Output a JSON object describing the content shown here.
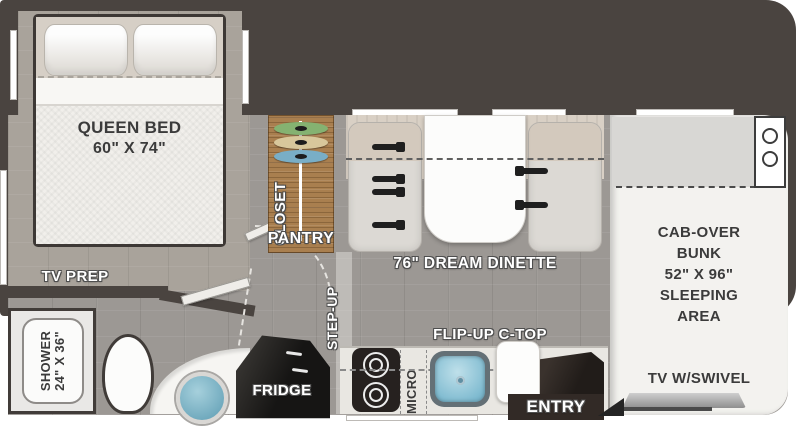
{
  "colors": {
    "wall": "#4a4440",
    "floor": "#9c9894",
    "bedroom_floor": "#a9a39b",
    "closet_wood": "#a97f4f",
    "sink_blue": "#7cb9cf",
    "fridge_black": "#1b1a19",
    "entry_dark": "#322a26"
  },
  "bedroom": {
    "bed_title": "QUEEN BED",
    "bed_size": "60\" X 74\"",
    "tv_prep_label": "TV PREP"
  },
  "bathroom": {
    "shower_title": "SHOWER",
    "shower_size": "24\" X 36\""
  },
  "storage": {
    "closet_label": "CLOSET",
    "pantry_label": "PANTRY"
  },
  "galley": {
    "step_up_label": "STEP-UP",
    "flip_up_label": "FLIP-UP C-TOP",
    "micro_label": "MICRO",
    "fridge_label": "FRIDGE",
    "entry_label": "ENTRY"
  },
  "dinette": {
    "label": "76\" DREAM DINETTE"
  },
  "bunk": {
    "line1": "CAB-OVER",
    "line2": "BUNK",
    "line3": "52\" X 96\"",
    "line4": "SLEEPING",
    "line5": "AREA",
    "tv_label": "TV W/SWIVEL"
  }
}
